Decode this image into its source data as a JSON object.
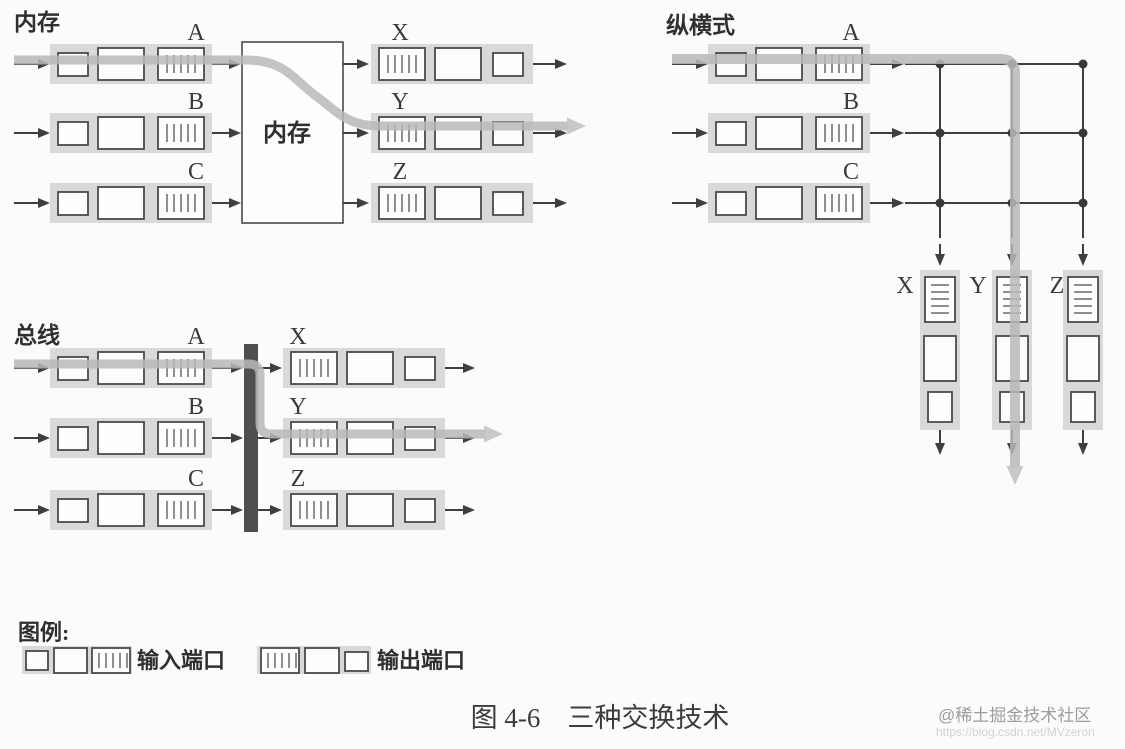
{
  "figure": {
    "caption": "图 4-6　三种交换技术"
  },
  "diagrams": {
    "memory": {
      "title": "内存",
      "switch_label": "内存",
      "inputs": [
        "A",
        "B",
        "C"
      ],
      "outputs": [
        "X",
        "Y",
        "Z"
      ]
    },
    "crossbar": {
      "title": "纵横式",
      "inputs": [
        "A",
        "B",
        "C"
      ],
      "outputs": [
        "X",
        "Y",
        "Z"
      ]
    },
    "bus": {
      "title": "总线",
      "inputs": [
        "A",
        "B",
        "C"
      ],
      "outputs": [
        "X",
        "Y",
        "Z"
      ]
    }
  },
  "legend": {
    "title": "图例:",
    "input_port_label": "输入端口",
    "output_port_label": "输出端口"
  },
  "watermark": {
    "text": "@稀土掘金技术社区",
    "url": "https://blog.csdn.net/MVzeron"
  },
  "colors": {
    "highlight_path": "#b9b9b9",
    "port_band": "#d9d9d9",
    "line": "#3f3f3f",
    "bus_bar": "#4f4f4f"
  }
}
